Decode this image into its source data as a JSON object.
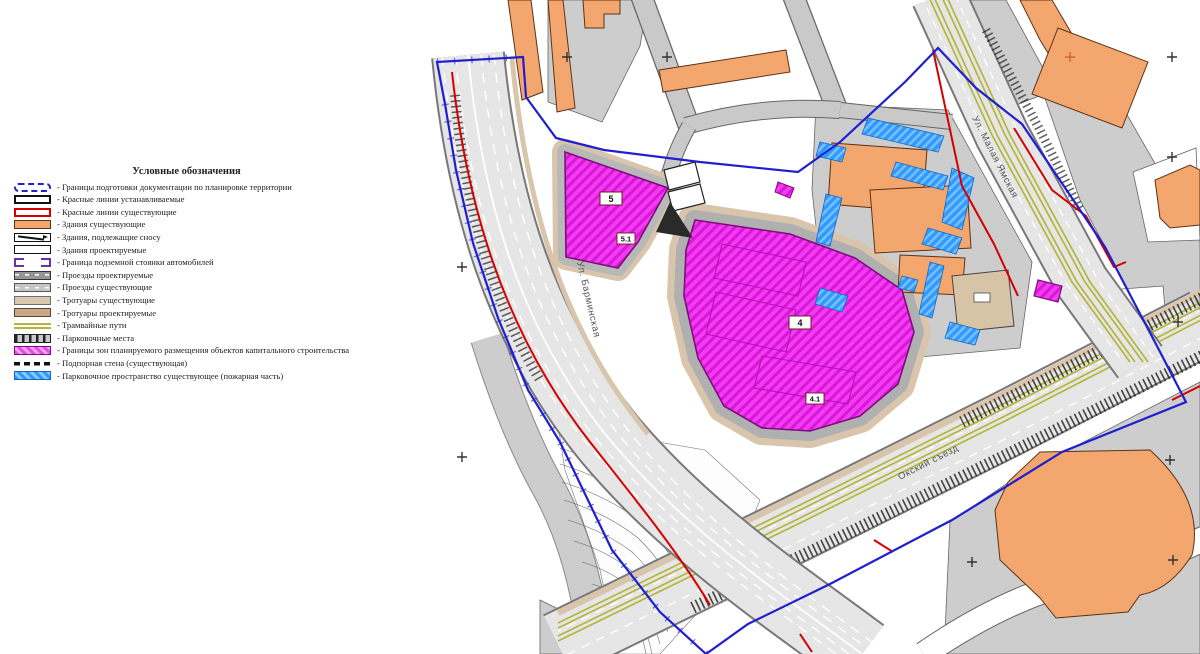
{
  "legend": {
    "title": "Условные обозначения",
    "items": [
      {
        "label": "- Границы подготовки документации по планировке территории"
      },
      {
        "label": "- Красные линии устанавливаемые"
      },
      {
        "label": "- Красные линии существующие"
      },
      {
        "label": "- Здания существующие"
      },
      {
        "label": "- Здания, подлежащие сносу"
      },
      {
        "label": "- Здания проектируемые"
      },
      {
        "label": "- Граница подземной стоянки автомобилей"
      },
      {
        "label": "- Проезды проектируемые"
      },
      {
        "label": "- Проезды существующие"
      },
      {
        "label": "- Тротуары существующие"
      },
      {
        "label": "- Тротуары проектируемые"
      },
      {
        "label": "- Трамвайные пути"
      },
      {
        "label": "- Парковочные места"
      },
      {
        "label": "- Границы зон планируемого размещения объектов капитального строительства"
      },
      {
        "label": "- Подпорная стена (существующая)"
      },
      {
        "label": "- Парковочное пространство существующее (пожарная часть)"
      }
    ]
  },
  "map": {
    "streets": [
      {
        "name": "Ул. Барминская"
      },
      {
        "name": "Ул. Малая Ямская"
      },
      {
        "name": "Окский съезд"
      }
    ],
    "zones": [
      {
        "label": "5"
      },
      {
        "label": "5.1"
      },
      {
        "label": "4"
      },
      {
        "label": "4.1"
      }
    ],
    "colors": {
      "boundary_blue": "#1f1fd0",
      "red_line": "#d40000",
      "building_existing": "#f3a76e",
      "capital_construction_zone": "#f23cf0",
      "fire_parking_blue": "#2f9bff",
      "tram": "#b5b53e",
      "sidewalk": "#d9c7b0",
      "block_gray": "#cdcdcd"
    }
  }
}
